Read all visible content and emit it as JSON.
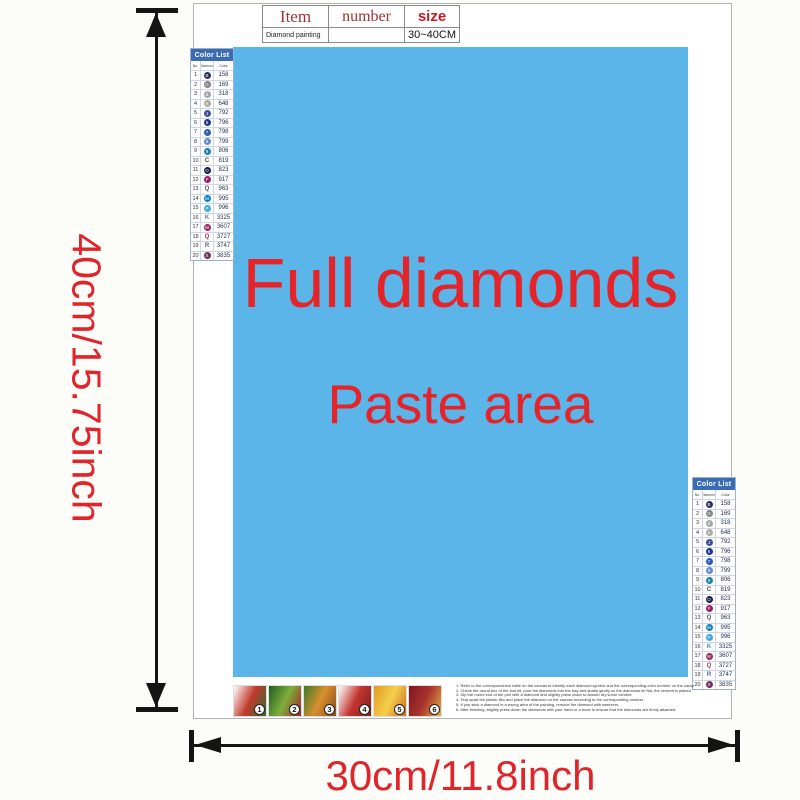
{
  "dimensions": {
    "vertical_label": "40cm/15.75inch",
    "horizontal_label": "30cm/11.8inch",
    "arrow_color": "#141414",
    "label_color": "#e0242a"
  },
  "info_table": {
    "headers": [
      {
        "label": "Item",
        "color": "#9b3234"
      },
      {
        "label": "number",
        "color": "#9b3234"
      },
      {
        "label": "size",
        "color": "#cc1822"
      }
    ],
    "row": {
      "item": "Diamond painting",
      "number": "",
      "size": "30~40CM"
    }
  },
  "canvas": {
    "bg": "#5cb5e8",
    "line1": "Full diamonds",
    "line2": "Paste area",
    "text_color": "#e5242a"
  },
  "color_list": {
    "title": "Color List",
    "title_bg": "#3a6cb4",
    "columns": [
      "No.",
      "Diamond",
      "Color"
    ],
    "rows": [
      {
        "no": "1",
        "code": "158",
        "sym": "B",
        "style": "circle",
        "color": "#2b2f5e"
      },
      {
        "no": "2",
        "code": "169",
        "sym": "G",
        "style": "circle",
        "color": "#83827e"
      },
      {
        "no": "3",
        "code": "318",
        "sym": "d",
        "style": "circle",
        "color": "#a7a7a7"
      },
      {
        "no": "4",
        "code": "648",
        "sym": "e",
        "style": "circle",
        "color": "#aeaca0"
      },
      {
        "no": "5",
        "code": "792",
        "sym": "J",
        "style": "circle",
        "color": "#3b4f96"
      },
      {
        "no": "6",
        "code": "796",
        "sym": "6",
        "style": "circle",
        "color": "#20358f"
      },
      {
        "no": "7",
        "code": "798",
        "sym": "7",
        "style": "circle",
        "color": "#2d59b0"
      },
      {
        "no": "8",
        "code": "799",
        "sym": "8",
        "style": "circle",
        "color": "#6488c9"
      },
      {
        "no": "9",
        "code": "806",
        "sym": "9",
        "style": "circle",
        "color": "#1f7fb0"
      },
      {
        "no": "10",
        "code": "819",
        "sym": "C",
        "style": "letter",
        "color": "#444444"
      },
      {
        "no": "11",
        "code": "823",
        "sym": "O",
        "style": "circle",
        "color": "#171f4e"
      },
      {
        "no": "12",
        "code": "917",
        "sym": "F",
        "style": "circle",
        "color": "#a01c6e"
      },
      {
        "no": "13",
        "code": "963",
        "sym": "Q",
        "style": "letter",
        "color": "#555555"
      },
      {
        "no": "14",
        "code": "995",
        "sym": "M",
        "style": "circle",
        "color": "#0d7fc0"
      },
      {
        "no": "15",
        "code": "996",
        "sym": "P",
        "style": "circle",
        "color": "#3fa8dc"
      },
      {
        "no": "16",
        "code": "3325",
        "sym": "K",
        "style": "letter",
        "color": "#4f7fc0"
      },
      {
        "no": "17",
        "code": "3607",
        "sym": "W",
        "style": "circle",
        "color": "#9c2560"
      },
      {
        "no": "18",
        "code": "3727",
        "sym": "Q",
        "style": "letter",
        "color": "#a8355f"
      },
      {
        "no": "19",
        "code": "3747",
        "sym": "R",
        "style": "letter",
        "color": "#5a6096"
      },
      {
        "no": "20",
        "code": "3835",
        "sym": "X",
        "style": "circle",
        "color": "#6e3060"
      }
    ]
  },
  "steps": {
    "items": [
      {
        "n": "1",
        "colors": [
          "#ffffff",
          "#c13a2c",
          "#2f6b2f"
        ]
      },
      {
        "n": "2",
        "colors": [
          "#1f5c22",
          "#7fae3c",
          "#a32222"
        ]
      },
      {
        "n": "3",
        "colors": [
          "#3c7a2a",
          "#d98f2e",
          "#8a4a1c"
        ]
      },
      {
        "n": "4",
        "colors": [
          "#ffffff",
          "#c23530",
          "#7c201c"
        ]
      },
      {
        "n": "5",
        "colors": [
          "#e09a22",
          "#f5cf4c",
          "#c96c1a"
        ]
      },
      {
        "n": "6",
        "colors": [
          "#7c1622",
          "#aa332c",
          "#e2b244"
        ]
      }
    ]
  },
  "instructions": {
    "lines": [
      "1. Refer to the correspondence table on the canvas to identify each diamond symbol and the corresponding color number on the canvas.",
      "2. Check the round box of the tool kit, pour the diamonds into the tray and shake gently so the diamonds lie flat, the cement is placed.",
      "3. Dip the round end of the pen with a diamond and slightly press down to absorb dry some cement.",
      "4. Tear apart the plastic film and place the diamond on the canvas according to the corresponding number.",
      "5. If you stick a diamond in a wrong area of the painting, remove the diamond with tweezers.",
      "6. After finishing, slightly press down the diamonds with your hand or a book to ensure that the diamonds are firmly attached."
    ]
  }
}
